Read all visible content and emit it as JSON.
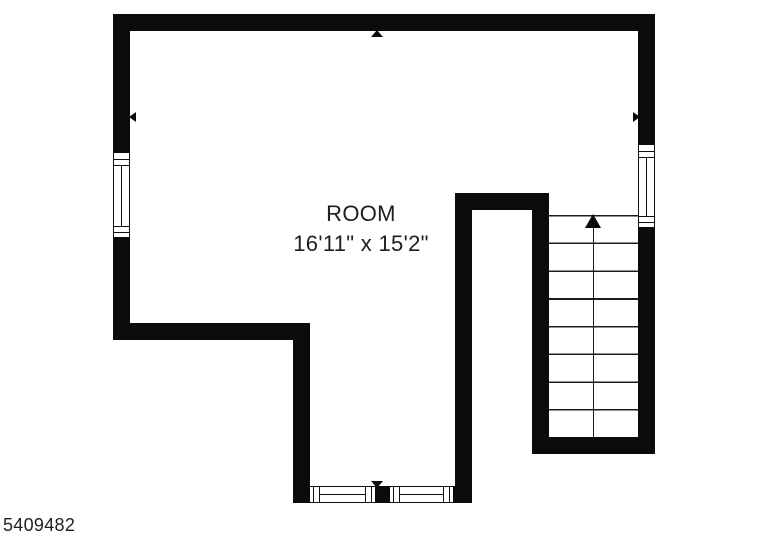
{
  "plan": {
    "room": {
      "name": "ROOM",
      "dimensions": "16'11\" x 15'2\""
    },
    "stairs": {
      "steps": 8,
      "arrow_direction": "up"
    },
    "windows": [
      "left-wall-window",
      "right-wall-window",
      "bottom-wall-window-left",
      "bottom-wall-window-right"
    ],
    "wall_markers": [
      "top-up",
      "left-out",
      "right-out",
      "bottom-down"
    ],
    "id_label": "5409482",
    "colors": {
      "wall": "#0b0b0b",
      "background": "#ffffff",
      "text": "#1f1f1f",
      "stair_line": "#1c1c1c"
    }
  }
}
